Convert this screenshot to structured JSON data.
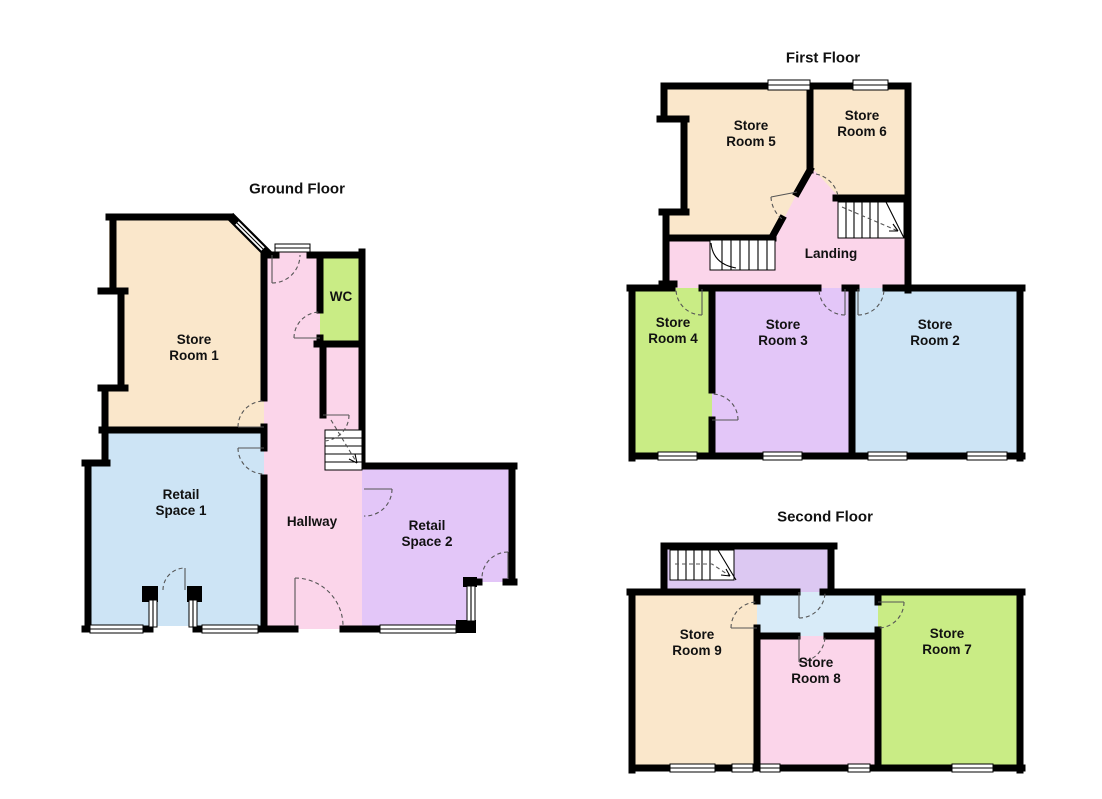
{
  "colors": {
    "background": "#ffffff",
    "wall": "#000000",
    "room_wheat": "#FAE7CB",
    "room_blue": "#CDE4F5",
    "room_pink": "#FBD5EA",
    "room_green": "#C9EC85",
    "room_purple": "#E3C6F8",
    "room_lavender": "#DCC8F2",
    "room_hall_blue": "#D8EBF8"
  },
  "floors": [
    {
      "title": "Ground Floor",
      "rooms": [
        {
          "label": "Store Room 1"
        },
        {
          "label": "WC"
        },
        {
          "label": "Retail Space 1"
        },
        {
          "label": "Hallway"
        },
        {
          "label": "Retail Space 2"
        }
      ]
    },
    {
      "title": "First Floor",
      "rooms": [
        {
          "label": "Store Room 5"
        },
        {
          "label": "Store Room 6"
        },
        {
          "label": "Landing"
        },
        {
          "label": "Store Room 4"
        },
        {
          "label": "Store Room 3"
        },
        {
          "label": "Store Room 2"
        }
      ]
    },
    {
      "title": "Second Floor",
      "rooms": [
        {
          "label": "Store Room 9"
        },
        {
          "label": "Store Room 8"
        },
        {
          "label": "Store Room 7"
        }
      ]
    }
  ]
}
